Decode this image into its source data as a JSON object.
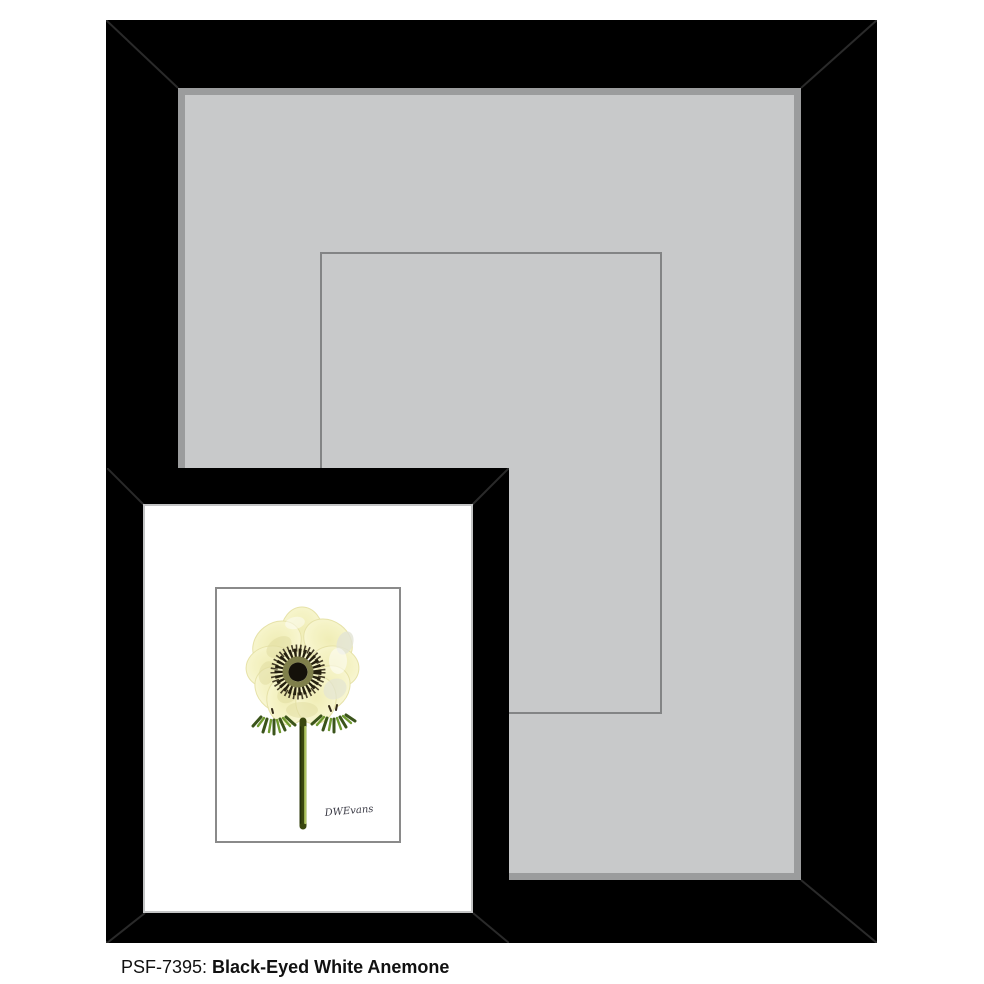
{
  "product": {
    "sku_label": "PSF-7395:",
    "title": "Black-Eyed White Anemone",
    "signature": "DWEvans"
  },
  "colors": {
    "background": "#ffffff",
    "frameBlack": "#000000",
    "miterLine": "#2a2a2a",
    "matGray": "#c8c9ca",
    "matShadow": "#9b9c9d",
    "openingLine": "#838485",
    "smallMatEdge": "#c3c4c5",
    "smallMatWhite": "#ffffff",
    "artworkBorder": "#8a8a8a",
    "artworkBg": "#ffffff",
    "petalDeep": "#f0edb6",
    "petalLight": "#f5f3c6",
    "petalPale": "#faf8da",
    "petalOutline": "#e6e2a8",
    "petalShade": "#e0dca0",
    "petalSheen": "#e2e3d4",
    "stamenSpike": "#332a18",
    "stamenDark": "#25200f",
    "oliveRing": "#7f7f4b",
    "centerBlack": "#14110a",
    "leafDark": "#3b541b",
    "leafLight": "#6f9a30",
    "stemDark": "#3a470f",
    "stemEdge": "#222d09",
    "stemLight": "#b5cc66",
    "captionColor": "#111111"
  }
}
